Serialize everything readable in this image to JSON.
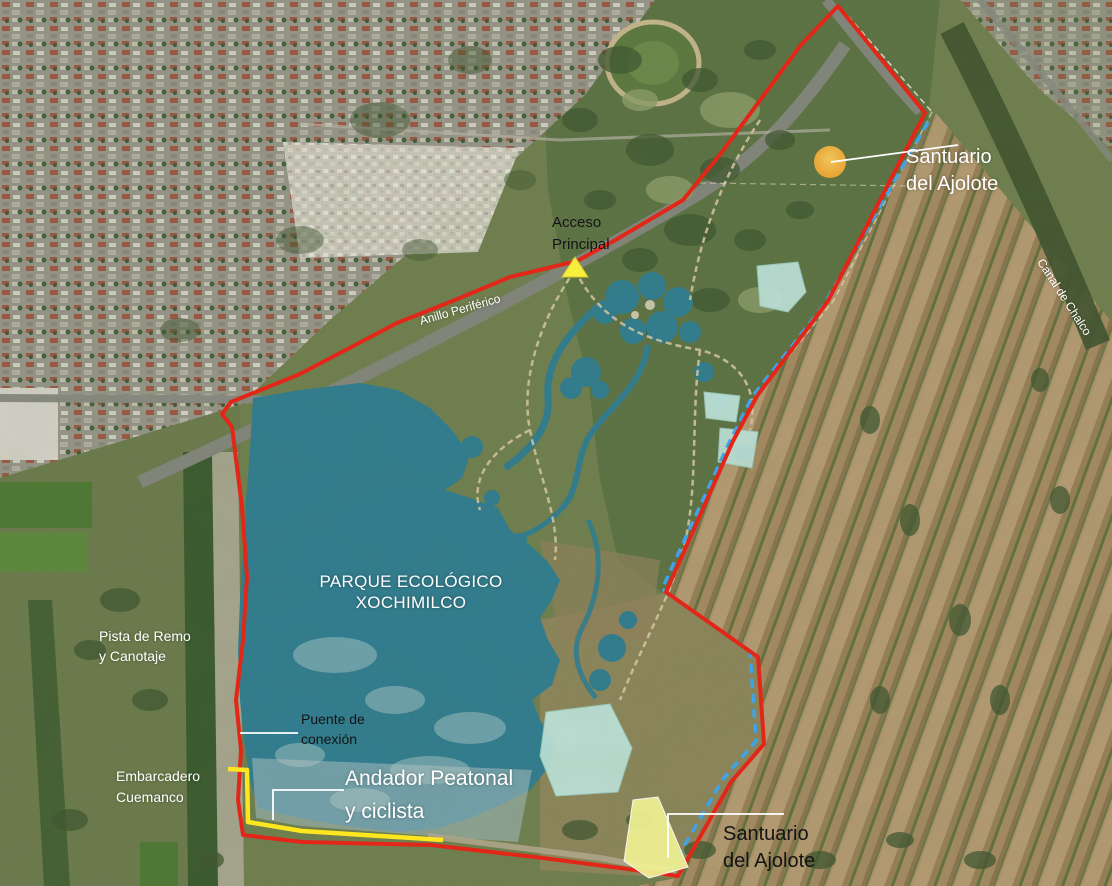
{
  "labels": {
    "park_title": {
      "line1": "PARQUE ECOLÓGICO",
      "line2": "XOCHIMILCO"
    },
    "sanctuary_north": {
      "line1": "Santuario",
      "line2": "del Ajolote"
    },
    "sanctuary_south": {
      "line1": "Santuario",
      "line2": "del Ajolote"
    },
    "main_access": {
      "line1": "Acceso",
      "line2": "Principal"
    },
    "ring_road": {
      "text": "Anillo Periférico"
    },
    "chalco_canal": {
      "text": "Canal de Chalco"
    },
    "rowing_course": {
      "line1": "Pista de Remo",
      "line2": "y Canotaje"
    },
    "pier": {
      "line1": "Embarcadero",
      "line2": "Cuemanco"
    },
    "connection_bridge": {
      "line1": "Puente de",
      "line2": "conexión"
    },
    "walkway": {
      "line1": "Andador Peatonal",
      "line2": "y ciclista"
    }
  },
  "overlay": {
    "boundary_color": "#e22718",
    "canal_line_color": "#3fa3e8",
    "walkway_color": "#ffe61e",
    "sanctuary_marker_color": "#f2a83b",
    "sanctuary_area_color": "#f0f193",
    "access_marker_color": "#f8ee3c",
    "wetland_color": "#c5ebe3",
    "leader_line_color": "#ffffff",
    "lake_color": "#2f7e93"
  }
}
